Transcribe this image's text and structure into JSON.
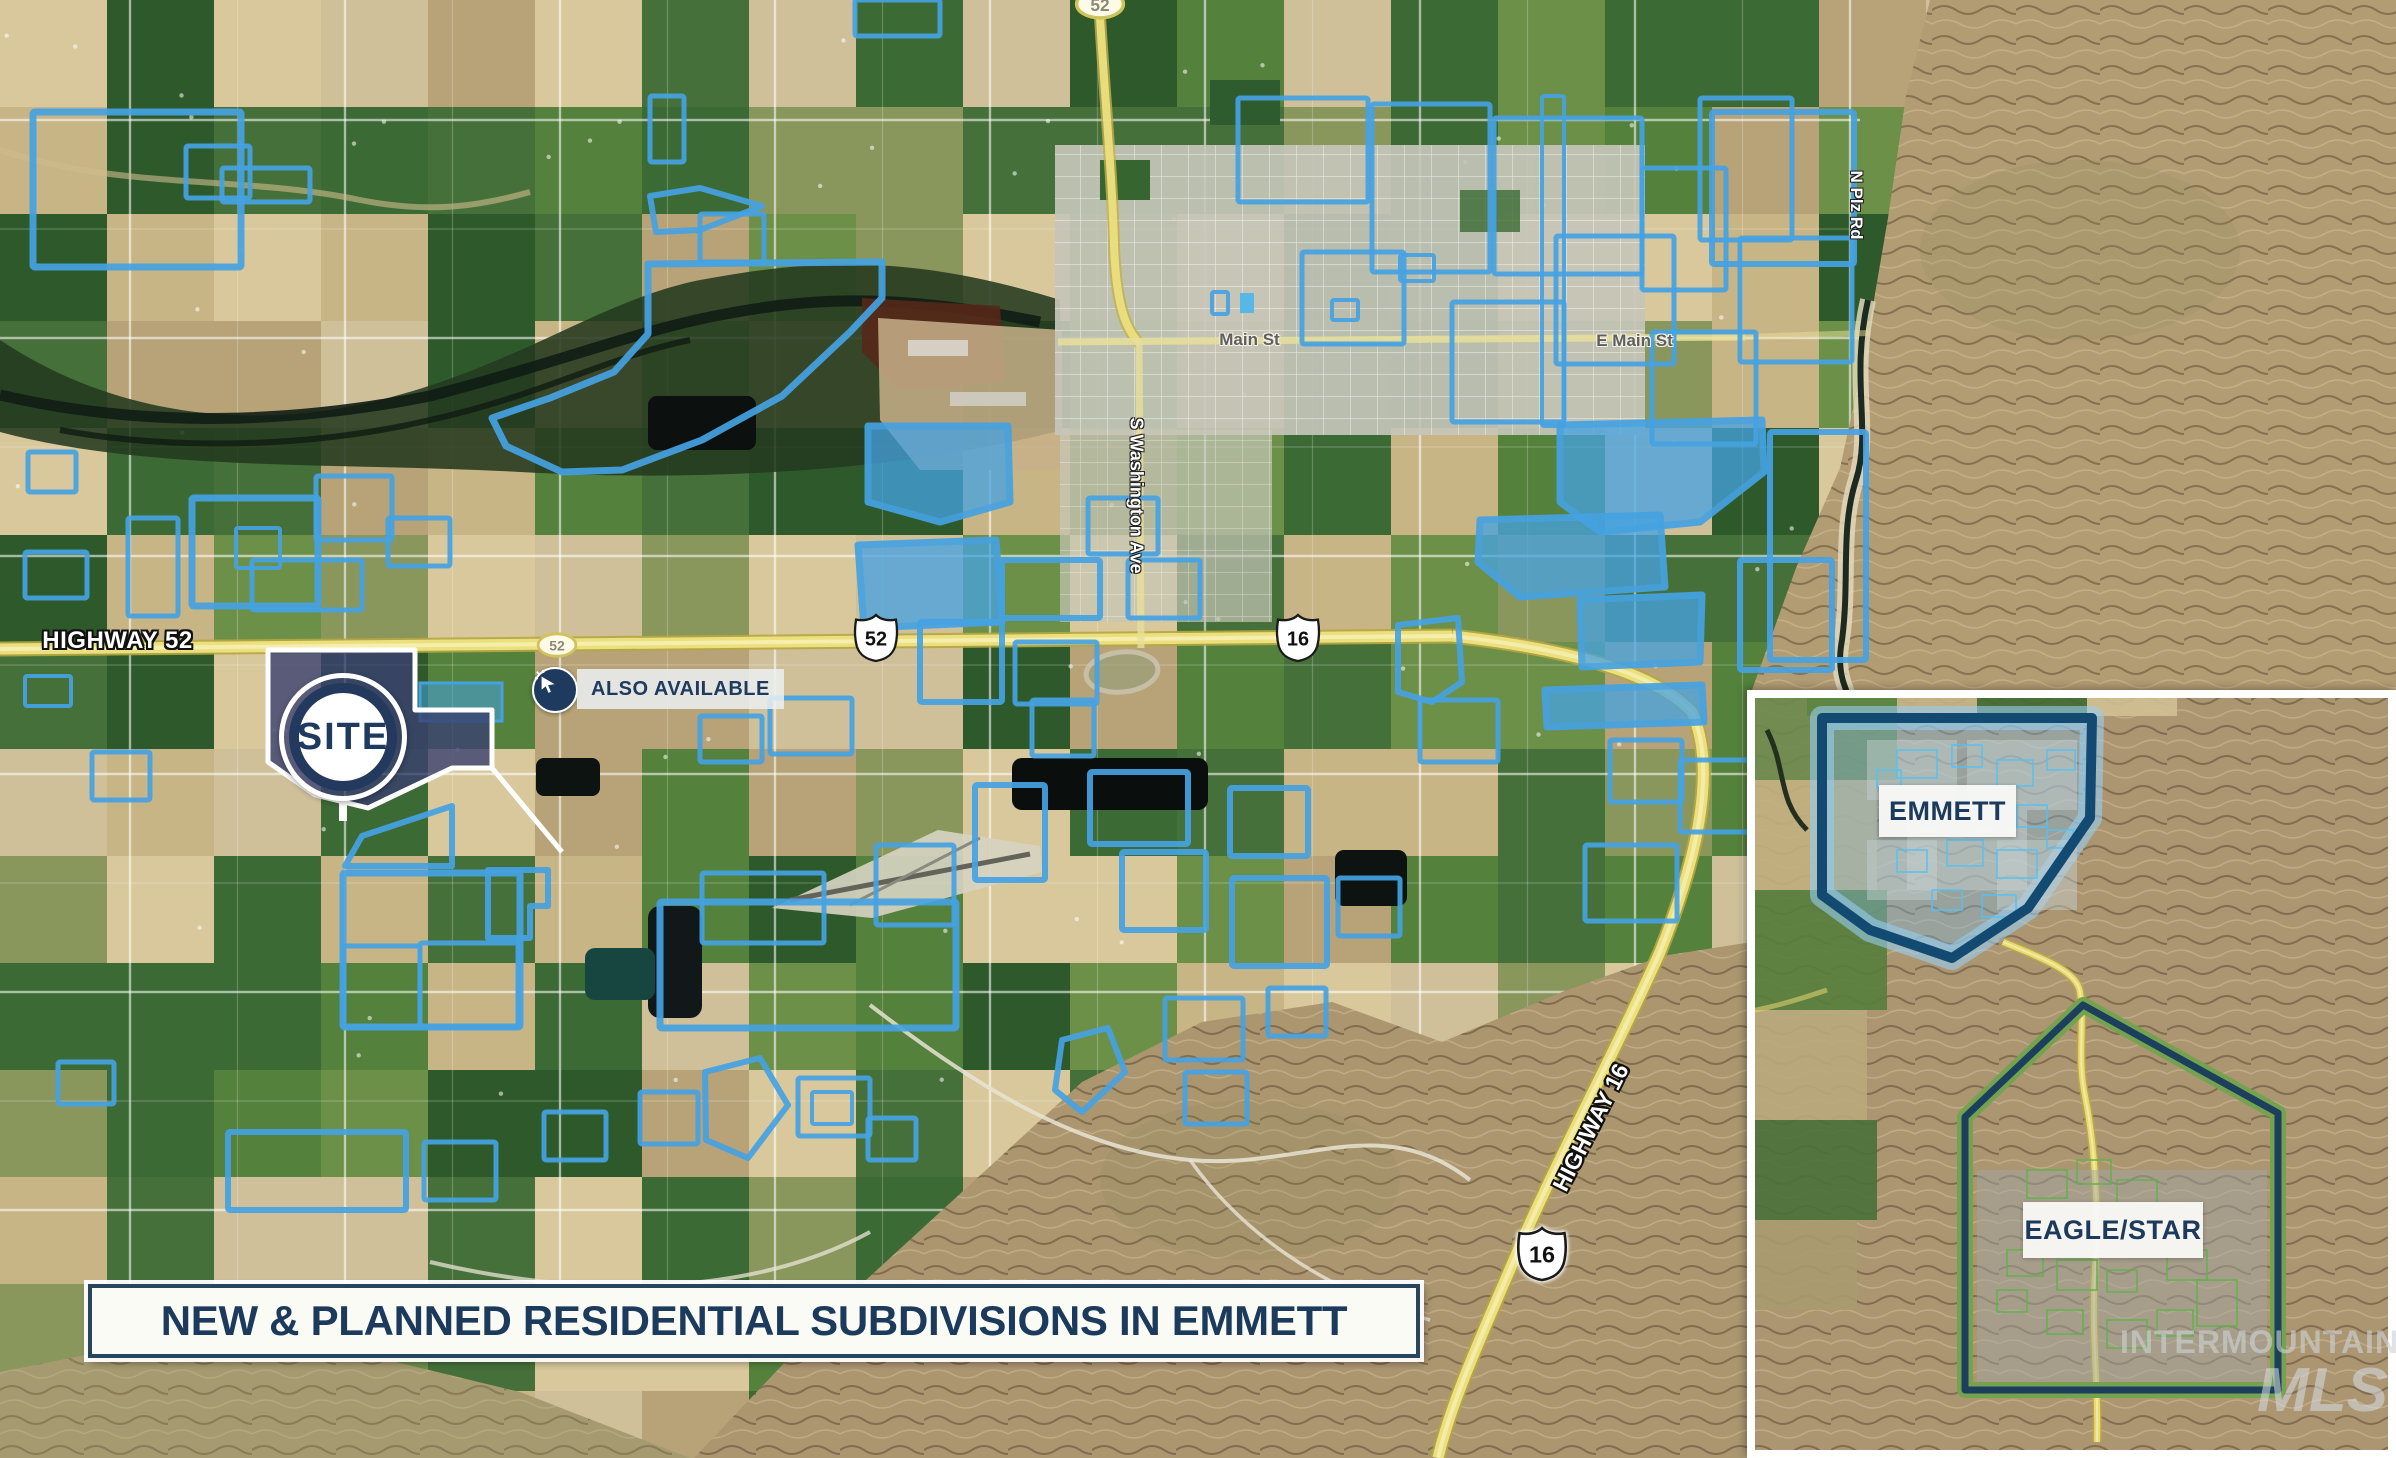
{
  "banner": {
    "text": "NEW & PLANNED RESIDENTIAL SUBDIVISIONS IN EMMETT"
  },
  "map": {
    "labels": {
      "highway52": "HIGHWAY 52",
      "highway16": "HIGHWAY 16",
      "main_st": "Main St",
      "e_main_st": "E Main St",
      "s_washington": "S Washington Ave",
      "n_plz": "N Plz Rd"
    },
    "shields": {
      "oval_top": "52",
      "oval_mid": "52",
      "us_west": "52",
      "us_east": "16",
      "us_south": "16"
    },
    "site_marker": {
      "label": "SITE"
    },
    "also_available": {
      "label": "ALSO AVAILABLE"
    },
    "colors": {
      "subdivision_outline": "#45a2e2",
      "site_fill": "#3a4070",
      "navy": "#1e3a5e",
      "highway_yellow": "#ecdf7e",
      "emmett_area_border": "#134a72",
      "eagle_area_border": "#74a24e"
    },
    "site": {
      "poly": "268,650 415,650 415,710 492,710 492,768 452,768 368,808 315,795 268,762",
      "pointer": "452,768 492,768 562,852",
      "adjacent_parcel": [
        420,
        683,
        82,
        38
      ]
    },
    "subdivisions": [
      {
        "r": [
          33,
          112,
          208,
          155
        ]
      },
      {
        "r": [
          186,
          146,
          64,
          52
        ],
        "w": 5
      },
      {
        "r": [
          222,
          168,
          88,
          34
        ],
        "w": 5
      },
      {
        "r": [
          28,
          452,
          48,
          40
        ],
        "w": 5
      },
      {
        "r": [
          25,
          552,
          62,
          46
        ],
        "w": 5
      },
      {
        "r": [
          25,
          676,
          46,
          30
        ],
        "w": 4
      },
      {
        "r": [
          92,
          752,
          58,
          48
        ],
        "w": 5
      },
      {
        "r": [
          128,
          518,
          50,
          98
        ],
        "w": 5
      },
      {
        "r": [
          192,
          498,
          126,
          108
        ]
      },
      {
        "r": [
          316,
          476,
          76,
          64
        ],
        "w": 5
      },
      {
        "r": [
          236,
          528,
          44,
          40
        ],
        "w": 4
      },
      {
        "r": [
          252,
          560,
          110,
          50
        ],
        "w": 5
      },
      {
        "r": [
          388,
          518,
          62,
          48
        ],
        "w": 5
      },
      {
        "r": [
          650,
          96,
          34,
          66
        ],
        "w": 5
      },
      {
        "r": [
          855,
          0,
          85,
          36
        ],
        "w": 5
      },
      {
        "p": "650,196 700,188 762,206 700,230 656,232",
        "w": 6
      },
      {
        "r": [
          700,
          214,
          64,
          48
        ],
        "w": 5
      },
      {
        "p": "648,264 882,262 882,298 850,332 782,396 702,440 622,470 562,472 506,446 492,418 550,398 614,372 648,334",
        "w": 7
      },
      {
        "p": "868,426 1008,426 1010,502 940,522 868,502",
        "f": 1
      },
      {
        "p": "858,545 996,540 1002,622 864,628",
        "f": 1
      },
      {
        "r": [
          1002,
          560,
          98,
          58
        ],
        "w": 6
      },
      {
        "r": [
          1088,
          498,
          70,
          56
        ],
        "w": 5
      },
      {
        "r": [
          1128,
          560,
          72,
          58
        ],
        "w": 5
      },
      {
        "r": [
          1212,
          292,
          16,
          22
        ],
        "w": 4
      },
      {
        "r": [
          1332,
          300,
          26,
          20
        ],
        "w": 4
      },
      {
        "r": [
          1400,
          255,
          34,
          26
        ],
        "w": 4
      },
      {
        "r": [
          1238,
          98,
          130,
          104
        ],
        "w": 5
      },
      {
        "r": [
          1372,
          104,
          118,
          168
        ],
        "w": 5
      },
      {
        "r": [
          1494,
          118,
          148,
          156
        ],
        "w": 5
      },
      {
        "r": [
          1556,
          236,
          118,
          128
        ],
        "w": 5
      },
      {
        "r": [
          1642,
          168,
          84,
          122
        ],
        "w": 5
      },
      {
        "r": [
          1700,
          98,
          92,
          142
        ],
        "w": 5
      },
      {
        "r": [
          1740,
          238,
          112,
          124
        ],
        "w": 5
      },
      {
        "r": [
          1652,
          332,
          104,
          112
        ],
        "w": 5
      },
      {
        "r": [
          1452,
          302,
          112,
          120
        ],
        "w": 5
      },
      {
        "r": [
          1302,
          252,
          102,
          92
        ],
        "w": 5
      },
      {
        "r": [
          1712,
          112,
          142,
          152
        ],
        "w": 6
      },
      {
        "r": [
          1542,
          96,
          22,
          330
        ],
        "w": 4
      },
      {
        "p": "1560,425 1762,420 1764,472 1700,522 1600,532 1560,502",
        "f": 1
      },
      {
        "p": "1480,520 1660,515 1665,587 1520,597 1478,562",
        "f": 1
      },
      {
        "p": "1580,600 1702,595 1700,662 1582,667",
        "f": 1
      },
      {
        "r": [
          1770,
          432,
          96,
          228
        ],
        "w": 6
      },
      {
        "r": [
          1740,
          560,
          92,
          110
        ],
        "w": 6
      },
      {
        "p": "1545,690 1702,685 1704,722 1547,727",
        "f": 1
      },
      {
        "r": [
          1610,
          740,
          72,
          62
        ],
        "w": 5
      },
      {
        "r": [
          1680,
          760,
          82,
          72
        ],
        "w": 5
      },
      {
        "r": [
          1585,
          845,
          92,
          76
        ],
        "w": 5
      },
      {
        "p": "1398,625 1458,618 1462,682 1432,702 1398,692",
        "w": 6
      },
      {
        "r": [
          1420,
          700,
          78,
          62
        ],
        "w": 5
      },
      {
        "r": [
          975,
          785,
          70,
          95
        ],
        "w": 6
      },
      {
        "r": [
          1090,
          772,
          98,
          72
        ],
        "w": 6
      },
      {
        "r": [
          1230,
          788,
          78,
          68
        ],
        "w": 6
      },
      {
        "r": [
          1122,
          852,
          84,
          78
        ],
        "w": 6
      },
      {
        "r": [
          1232,
          878,
          95,
          88
        ],
        "w": 6
      },
      {
        "r": [
          1338,
          878,
          62,
          58
        ],
        "w": 5
      },
      {
        "r": [
          1165,
          998,
          78,
          62
        ],
        "w": 5
      },
      {
        "r": [
          1268,
          988,
          58,
          48
        ],
        "w": 5
      },
      {
        "p": "1062,1040 1108,1028 1125,1072 1082,1112 1055,1090",
        "w": 6
      },
      {
        "r": [
          1185,
          1072,
          62,
          52
        ],
        "w": 5
      },
      {
        "r": [
          58,
          1062,
          56,
          42
        ],
        "w": 5
      },
      {
        "r": [
          228,
          1132,
          178,
          78
        ],
        "w": 6
      },
      {
        "r": [
          424,
          1142,
          72,
          58
        ],
        "w": 5
      },
      {
        "r": [
          544,
          1112,
          62,
          48
        ],
        "w": 5
      },
      {
        "r": [
          640,
          1092,
          58,
          52
        ],
        "w": 5
      },
      {
        "p": "705,1072 760,1058 788,1105 748,1158 706,1140",
        "w": 6
      },
      {
        "r": [
          798,
          1078,
          72,
          58
        ],
        "w": 5
      },
      {
        "r": [
          812,
          1092,
          40,
          32
        ],
        "w": 4
      },
      {
        "r": [
          868,
          1118,
          48,
          42
        ],
        "w": 5
      },
      {
        "r": [
          343,
          873,
          177,
          154
        ],
        "w": 7
      },
      {
        "r": [
          343,
          946,
          77,
          81
        ],
        "w": 5
      },
      {
        "r": [
          420,
          943,
          98,
          84
        ],
        "w": 5
      },
      {
        "p": "345,866 362,836 452,806 452,866",
        "w": 6
      },
      {
        "p": "488,870 548,870 548,906 530,906 530,938 488,938",
        "w": 6
      },
      {
        "r": [
          660,
          902,
          296,
          126
        ],
        "w": 7
      },
      {
        "r": [
          702,
          873,
          122,
          70
        ],
        "w": 5
      },
      {
        "r": [
          876,
          845,
          78,
          80
        ],
        "w": 5
      },
      {
        "r": [
          700,
          716,
          62,
          46
        ],
        "w": 5
      },
      {
        "r": [
          770,
          698,
          82,
          56
        ],
        "w": 5
      },
      {
        "r": [
          920,
          622,
          82,
          80
        ],
        "w": 6
      },
      {
        "r": [
          1015,
          642,
          82,
          62
        ],
        "w": 5
      },
      {
        "r": [
          1032,
          700,
          62,
          56
        ],
        "w": 5
      }
    ]
  },
  "inset": {
    "areas": [
      {
        "label": "EMMETT"
      },
      {
        "label": "EAGLE/STAR"
      }
    ],
    "shield": "16",
    "emmett_poly": "75,28 345,28 343,128 281,218 205,268 123,240 75,205",
    "eagle_poly": "336,315 218,427 218,700 531,700 531,423"
  },
  "watermark": {
    "line1": "INTERMOUNTAIN",
    "line2": "MLS"
  }
}
